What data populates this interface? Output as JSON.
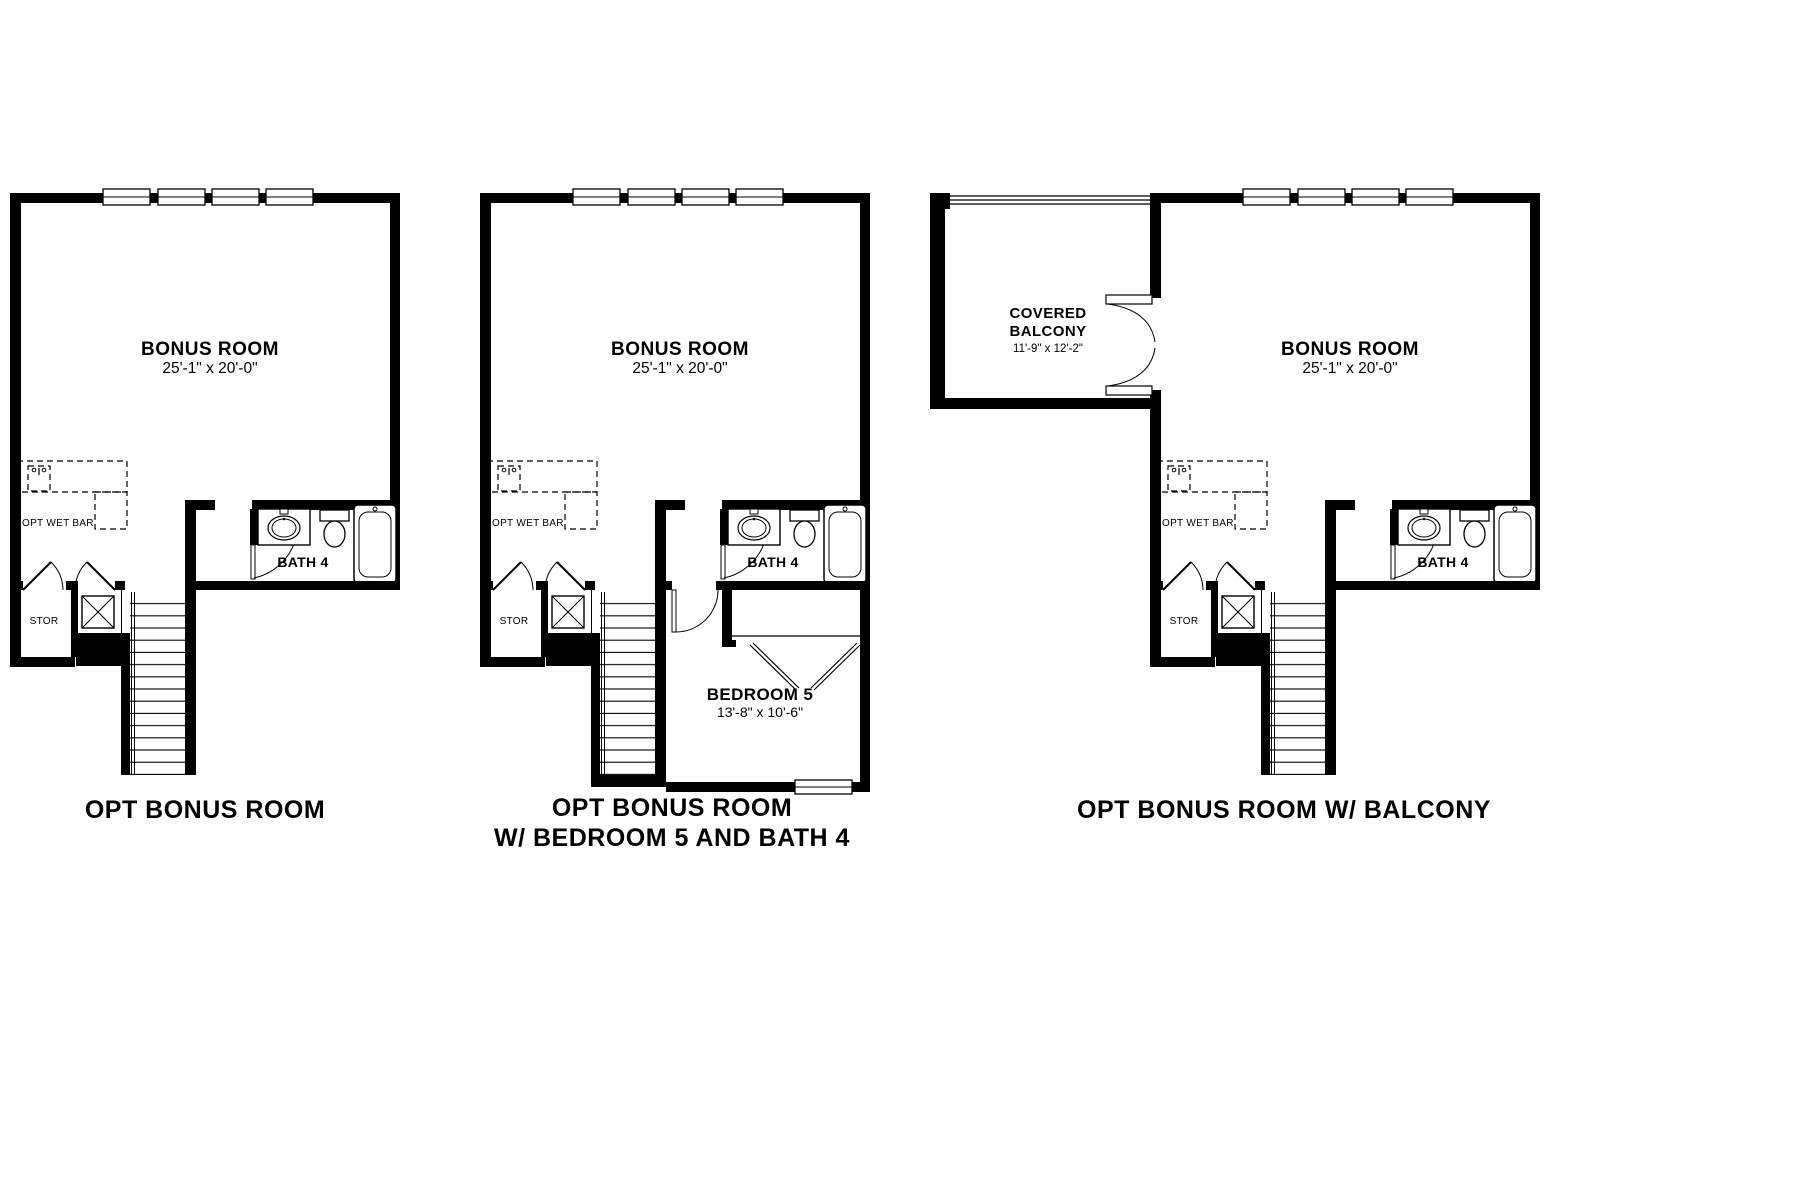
{
  "document": {
    "type": "floor-plan-options-sheet",
    "background_color": "#ffffff",
    "line_color": "#000000"
  },
  "common_labels": {
    "bonus_room": {
      "name": "BONUS ROOM",
      "dimensions": "25'-1\" x 20'-0\""
    },
    "wet_bar_label": "OPT WET BAR",
    "storage_label": "STOR",
    "bath_label": "BATH 4"
  },
  "plans": [
    {
      "title": "OPT BONUS ROOM"
    },
    {
      "title_line1": "OPT BONUS ROOM",
      "title_line2": "W/ BEDROOM 5 AND BATH 4",
      "bedroom": {
        "name": "BEDROOM 5",
        "dimensions": "13'-8\" x 10'-6\""
      }
    },
    {
      "title": "OPT BONUS ROOM W/ BALCONY",
      "balcony": {
        "name_line1": "COVERED",
        "name_line2": "BALCONY",
        "dimensions": "11'-9\" x 12'-2\""
      }
    }
  ]
}
